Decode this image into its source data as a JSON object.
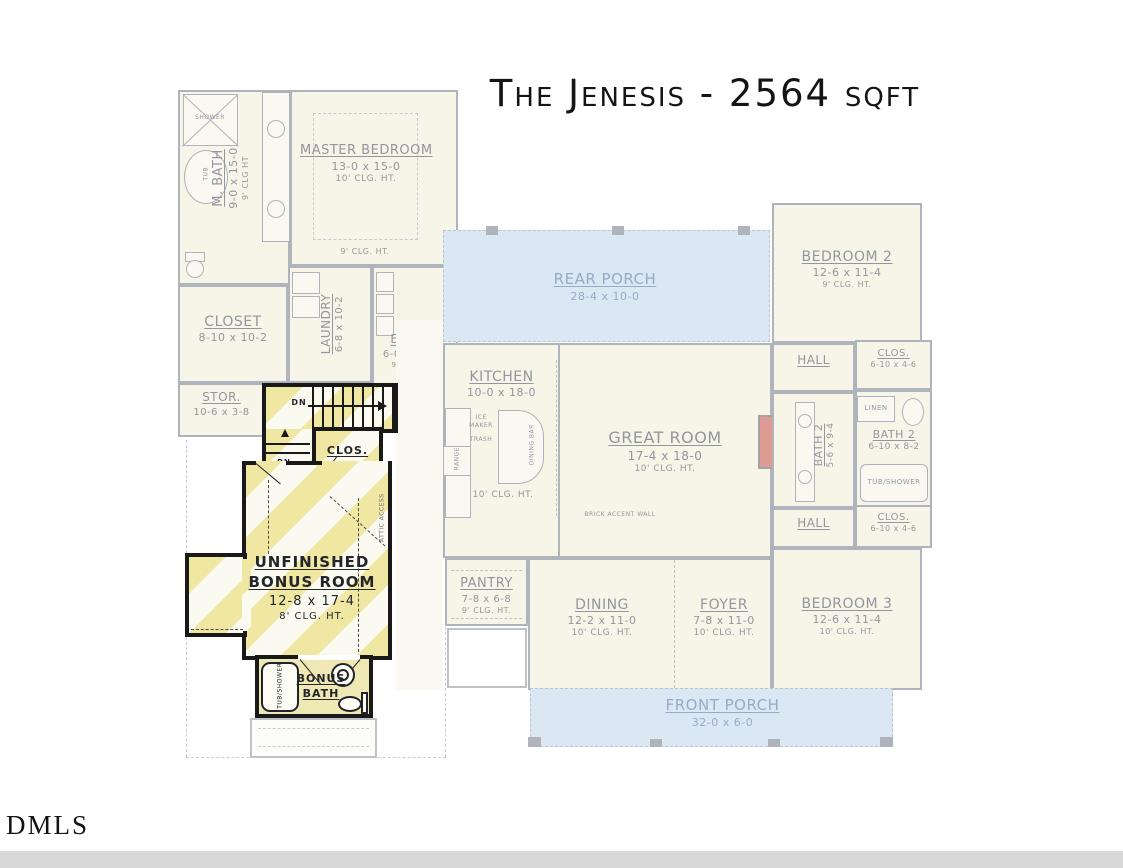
{
  "title": "The Jenesis - 2564 sqft",
  "watermark": "DMLS",
  "colors": {
    "highlight_stripe_yellow": "#efe7a2",
    "porch_blue": "#d7e3f1",
    "fireplace_red": "#c34a3e",
    "faded_wall_gray": "#6e7684",
    "faded_label_gray": "#3a424f",
    "bonus_wall_black": "#191919"
  },
  "first_floor": {
    "mbath": {
      "name": "M. BATH",
      "dims": "9-0 x 15-0",
      "clg": "9' CLG HT"
    },
    "shower": "SHOWER",
    "tub": "TUB",
    "lin": "LIN",
    "master": {
      "name": "MASTER BEDROOM",
      "dims": "13-0 x 15-0",
      "clg": "10' CLG. HT.",
      "clg_below": "9' CLG. HT."
    },
    "closet": {
      "name": "CLOSET",
      "dims": "8-10 x 10-2"
    },
    "laundry": {
      "name": "LAUNDRY",
      "dims": "6-8 x 10-2"
    },
    "entry": {
      "name": "ENTRY",
      "dims": "6-0 x 14-2",
      "clg": "9' CLG HT"
    },
    "stor": {
      "name": "STOR.",
      "dims": "10-6 x 3-8"
    },
    "rear_porch": {
      "name": "REAR PORCH",
      "dims": "28-4 x 10-0"
    },
    "kitchen": {
      "name": "KITCHEN",
      "dims": "10-0 x 18-0",
      "clg": "10' CLG. HT."
    },
    "ice_maker": "ICE MAKER",
    "trash": "TRASH",
    "range": "RANGE",
    "dining_bar": "DINING BAR",
    "arched_opening": "ARCHED OPENING",
    "great_room": {
      "name": "GREAT ROOM",
      "dims": "17-4 x 18-0",
      "clg": "10' CLG. HT."
    },
    "brick_accent": "BRICK ACCENT WALL",
    "bedroom2": {
      "name": "BEDROOM 2",
      "dims": "12-6 x 11-4",
      "clg": "9' CLG. HT."
    },
    "hall_upper": "HALL",
    "clos_upper": {
      "name": "CLOS.",
      "dims": "6-10 x 4-6"
    },
    "linen_fp": "LINEN",
    "bath2_long": {
      "name": "BATH 2",
      "dims": "5-6 x 9-4"
    },
    "linen": "LINEN",
    "bath2": {
      "name": "BATH 2",
      "dims": "6-10 x 8-2"
    },
    "tub_shower": "TUB/SHOWER",
    "hall_lower": "HALL",
    "clos_lower": {
      "name": "CLOS.",
      "dims": "6-10 x 4-6"
    },
    "pantry": {
      "name": "PANTRY",
      "dims": "7-8 x 6-8",
      "clg": "9' CLG. HT."
    },
    "dining": {
      "name": "DINING",
      "dims": "12-2 x 11-0",
      "clg": "10' CLG. HT."
    },
    "foyer": {
      "name": "FOYER",
      "dims": "7-8 x 11-0",
      "clg": "10' CLG. HT."
    },
    "bedroom3": {
      "name": "BEDROOM 3",
      "dims": "12-6 x 11-4",
      "clg": "10' CLG. HT."
    },
    "front_porch": {
      "name": "FRONT PORCH",
      "dims": "32-0 x 6-0"
    }
  },
  "bonus_level": {
    "room": {
      "name_line1": "UNFINISHED",
      "name_line2": "BONUS ROOM",
      "dims": "12-8 x 17-4",
      "clg": "8' CLG. HT."
    },
    "clos": "CLOS.",
    "bath_line1": "BONUS",
    "bath_line2": "BATH",
    "tub_shower": "TUB/SHOWER",
    "stairs_dn": "DN",
    "landing_dn": "DN",
    "attic_access": "ATTIC ACCESS"
  }
}
